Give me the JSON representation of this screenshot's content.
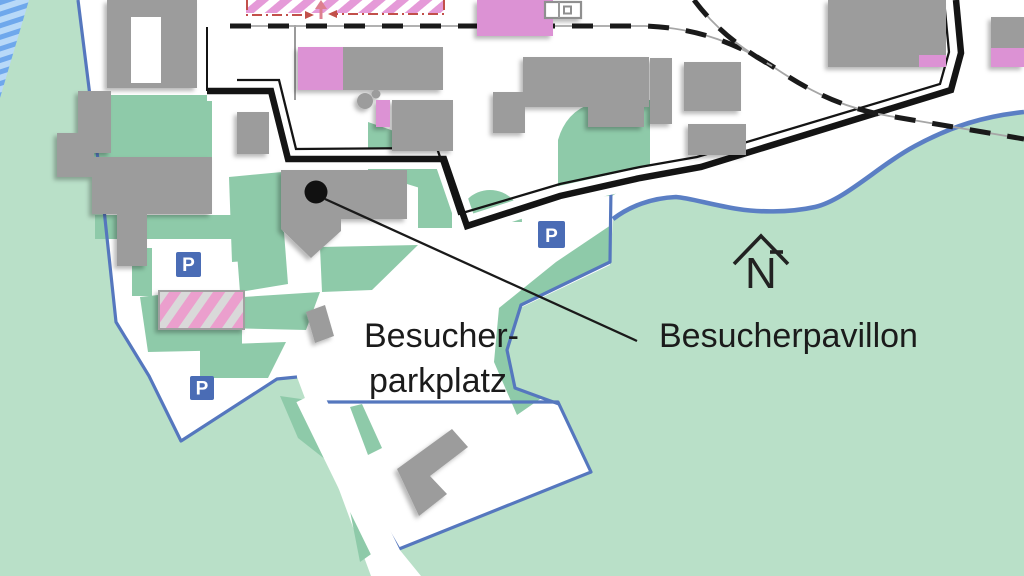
{
  "map": {
    "labels": {
      "parking_line1": "Besucher-",
      "parking_line2": "parkplatz",
      "pavilion": "Besucherpavillon",
      "parking_sign": "P",
      "north": "N"
    },
    "colors": {
      "surround_green": "#b9e0c8",
      "lawn_green": "#8ecaa9",
      "site_white": "#ffffff",
      "building_gray": "#9c9c9c",
      "building_pink": "#dc92d4",
      "stripe_pink": "#e59ad8",
      "water_light": "#b8d9f8",
      "water_dark": "#6fa8ec",
      "boundary_black": "#141414",
      "path_blue": "#5577be",
      "river_blue": "#5b7fc4",
      "parking_sign_blue": "#4a6cb5",
      "construction_red": "#c2504a",
      "label_text": "#1b1b1b"
    }
  }
}
